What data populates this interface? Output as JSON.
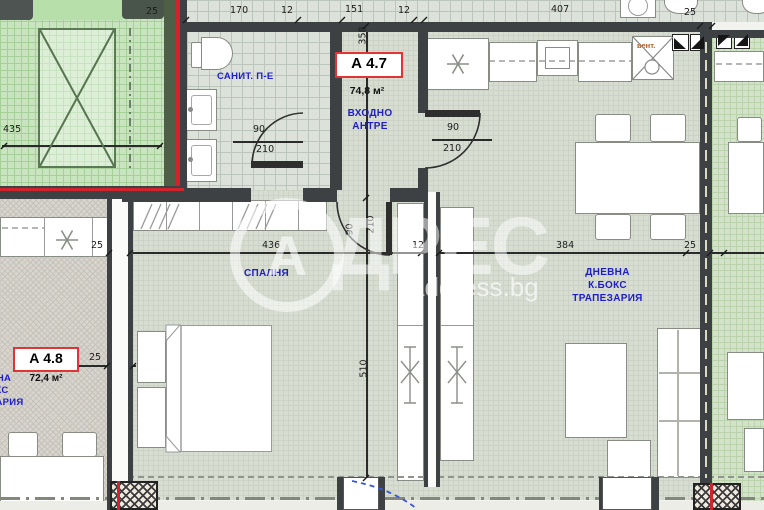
{
  "watermark": {
    "letter": "А",
    "word": "ДРЕС",
    "site": "address.bg"
  },
  "units": {
    "a47": {
      "id": "А 4.7",
      "area": "74,8 м²"
    },
    "a48": {
      "id": "А 4.8",
      "area": "72,4 м²"
    }
  },
  "rooms": {
    "bathroom": "САНИТ. П-Е",
    "hall_line1": "ВХОДНО",
    "hall_line2": "АНТРЕ",
    "bedroom": "СПАЛНЯ",
    "living_line1": "ДНЕВНА",
    "living_line2": "К.БОКС",
    "living_line3": "ТРАПЕЗАРИЯ",
    "vent": "вент."
  },
  "dims": {
    "top_25_left": "25",
    "top_170": "170",
    "top_12_a": "12",
    "top_151": "151",
    "top_12_b": "12",
    "top_407": "407",
    "top_25_right": "25",
    "green_435": "435",
    "hall_358": "358",
    "bedroom_510": "510",
    "mid_25_left": "25",
    "mid_436": "436",
    "mid_12": "12",
    "mid_384": "384",
    "mid_25_right": "25",
    "a48_wall_25": "25",
    "door_width_90": "90",
    "door_height_210": "210"
  },
  "colors": {
    "label_blue": "#1e1ecb",
    "unit_border_red": "#e23434",
    "boundary_red": "#d0232b",
    "common_green": "#c8e5bf",
    "wall_dark": "#3e4144",
    "vent_orange": "#b35a1e"
  }
}
